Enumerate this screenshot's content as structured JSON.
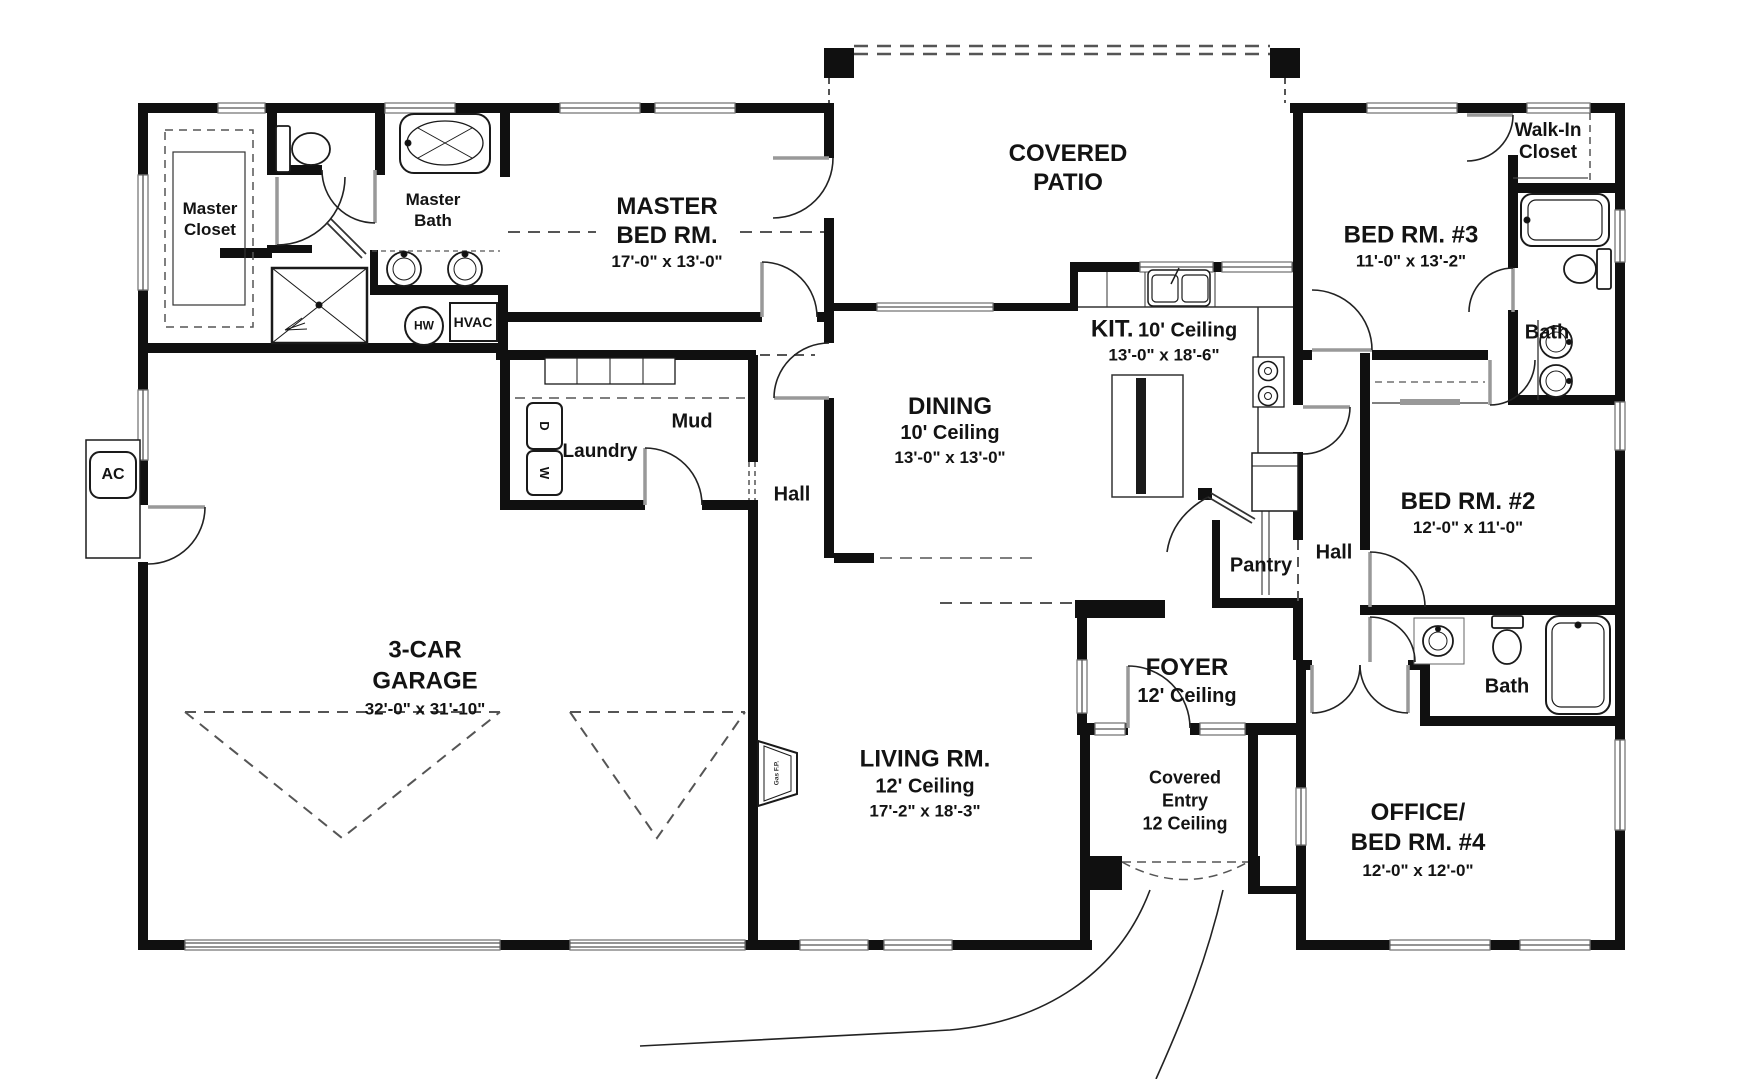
{
  "meta": {
    "drawing_type": "residential floor plan"
  },
  "colors": {
    "wall": "#101010",
    "thin_line": "#333333",
    "dash_line": "#555555",
    "door_leaf": "#999999",
    "window": "#7a7a7a",
    "text": "#131313",
    "background": "#ffffff"
  },
  "rooms": {
    "master_closet": {
      "line1": "Master",
      "line2": "Closet"
    },
    "master_bath": {
      "line1": "Master",
      "line2": "Bath"
    },
    "master_bedroom": {
      "line1": "MASTER",
      "line2": "BED RM.",
      "dims": "17'-0\" x 13'-0\""
    },
    "covered_patio": {
      "line1": "COVERED",
      "line2": "PATIO"
    },
    "bedroom3": {
      "name": "BED RM. #3",
      "dims": "11'-0\" x 13'-2\""
    },
    "walk_in_closet": {
      "line1": "Walk-In",
      "line2": "Closet"
    },
    "bath_upper": {
      "name": "Bath"
    },
    "kitchen": {
      "name": "KIT.",
      "ceiling": "10' Ceiling",
      "dims": "13'-0\" x 18'-6\""
    },
    "dining": {
      "name": "DINING",
      "ceiling": "10' Ceiling",
      "dims": "13'-0\" x 13'-0\""
    },
    "mud": {
      "name": "Mud"
    },
    "laundry": {
      "name": "Laundry"
    },
    "hall_center": {
      "name": "Hall"
    },
    "hall_east": {
      "name": "Hall"
    },
    "pantry": {
      "name": "Pantry"
    },
    "bedroom2": {
      "name": "BED RM. #2",
      "dims": "12'-0\" x 11'-0\""
    },
    "foyer": {
      "name": "FOYER",
      "ceiling": "12' Ceiling"
    },
    "covered_entry": {
      "line1": "Covered",
      "line2": "Entry",
      "line3": "12 Ceiling"
    },
    "garage": {
      "line1": "3-CAR",
      "line2": "GARAGE",
      "dims": "32'-0\" x 31'-10\""
    },
    "living": {
      "name": "LIVING RM.",
      "ceiling": "12' Ceiling",
      "dims": "17'-2\" x 18'-3\""
    },
    "office": {
      "line1": "OFFICE/",
      "line2": "BED RM. #4",
      "dims": "12'-0\" x 12'-0\""
    },
    "bath_lower": {
      "name": "Bath"
    }
  },
  "equipment": {
    "ac": "AC",
    "hot_water": "HW",
    "hvac": "HVAC",
    "dryer": "D",
    "washer": "W",
    "fireplace": "Gas F.P."
  }
}
